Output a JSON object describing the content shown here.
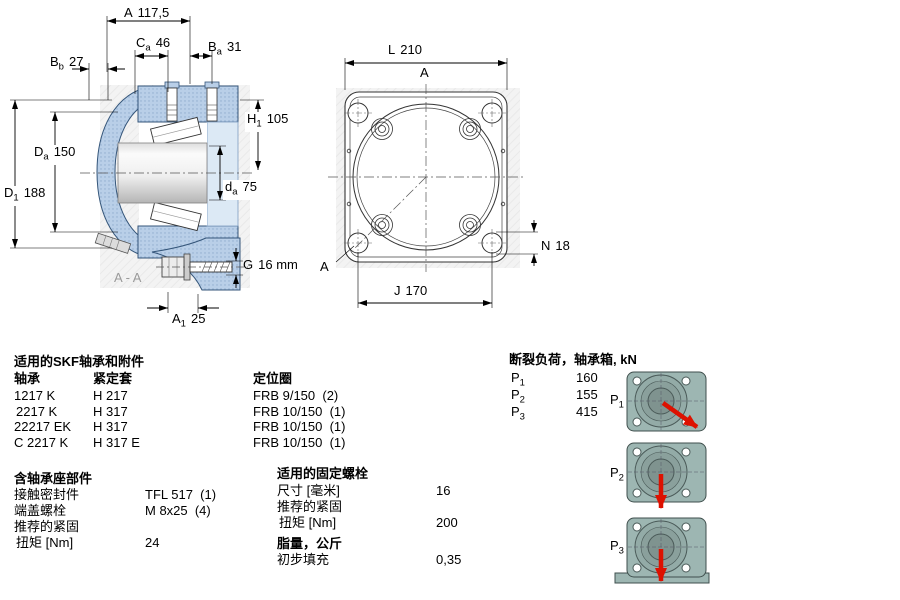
{
  "drawing_left": {
    "section_label": "A - A",
    "dims": {
      "A": {
        "pre": "A",
        "sub": "",
        "post": "117,5"
      },
      "Ca": {
        "pre": "C",
        "sub": "a",
        "post": "46"
      },
      "Ba": {
        "pre": "B",
        "sub": "a",
        "post": "31"
      },
      "Bb": {
        "pre": "B",
        "sub": "b",
        "post": "27"
      },
      "H1": {
        "pre": "H",
        "sub": "1",
        "post": "105"
      },
      "Da": {
        "pre": "D",
        "sub": "a",
        "post": "150"
      },
      "da": {
        "pre": "d",
        "sub": "a",
        "post": "75"
      },
      "D1": {
        "pre": "D",
        "sub": "1",
        "post": "188"
      },
      "G": {
        "pre": "G",
        "sub": "",
        "post": "16 mm"
      },
      "A1": {
        "pre": "A",
        "sub": "1",
        "post": "25"
      }
    }
  },
  "drawing_right": {
    "view_label_top": "A",
    "view_label_bottom": "A",
    "dims": {
      "L": {
        "pre": "L",
        "sub": "",
        "post": "210"
      },
      "N": {
        "pre": "N",
        "sub": "",
        "post": "18"
      },
      "J": {
        "pre": "J",
        "sub": "",
        "post": "170"
      }
    }
  },
  "bearings_table": {
    "title": "适用的SKF轴承和附件",
    "col_bearing": "轴承",
    "col_sleeve": "紧定套",
    "col_ring": "定位圈",
    "rows": [
      {
        "bearing": "1217 K",
        "sleeve": "H 217",
        "ring": "FRB 9/150  (2)"
      },
      {
        "bearing": "2217 K",
        "sleeve": "H 317",
        "ring": "FRB 10/150  (1)"
      },
      {
        "bearing": "22217 EK",
        "sleeve": "H 317",
        "ring": "FRB 10/150  (1)"
      },
      {
        "bearing": "C 2217 K",
        "sleeve": "H 317 E",
        "ring": "FRB 10/150  (1)"
      }
    ]
  },
  "housing_parts": {
    "title": "含轴承座部件",
    "rows": [
      {
        "label": "接触密封件",
        "value": "TFL 517  (1)"
      },
      {
        "label": "端盖螺栓",
        "value": "M 8x25  (4)"
      },
      {
        "label": "推荐的紧固",
        "value": ""
      },
      {
        "label": "扭矩 [Nm]",
        "value": "24"
      }
    ]
  },
  "fixing_bolts": {
    "title": "适用的固定螺栓",
    "rows": [
      {
        "label": "尺寸 [毫米]",
        "value": "16"
      },
      {
        "label": "推荐的紧固",
        "value": ""
      },
      {
        "label": "扭矩 [Nm]",
        "value": "200"
      }
    ]
  },
  "grease": {
    "title": "脂量，公斤",
    "rows": [
      {
        "label": "初步填充",
        "value": "0,35"
      }
    ]
  },
  "breaking_loads": {
    "title": "断裂负荷，轴承箱, kN",
    "rows": [
      {
        "pre": "P",
        "sub": "1",
        "value": "160"
      },
      {
        "pre": "P",
        "sub": "2",
        "value": "155"
      },
      {
        "pre": "P",
        "sub": "3",
        "value": "415"
      }
    ],
    "figures": [
      {
        "pre": "P",
        "sub": "1",
        "arrow": "diagonal-down-right"
      },
      {
        "pre": "P",
        "sub": "2",
        "arrow": "down"
      },
      {
        "pre": "P",
        "sub": "3",
        "arrow": "down-onto-base"
      }
    ]
  },
  "colors": {
    "housing_blue": "#b9cfe8",
    "figure_teal": "#9db6b2",
    "load_arrow_red": "#dd1100",
    "backdrop_gray": "#f3f3f3"
  }
}
